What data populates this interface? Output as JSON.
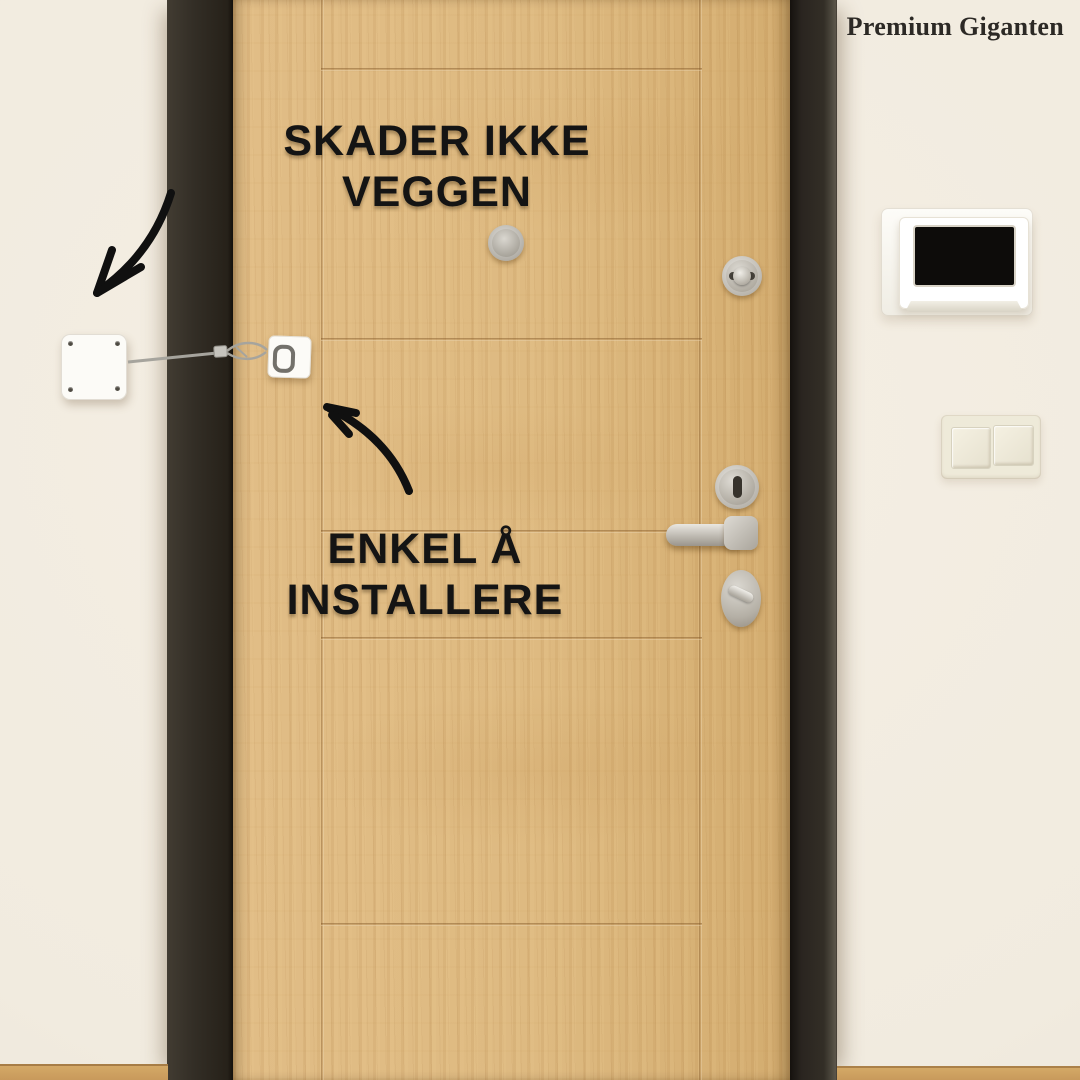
{
  "brand": {
    "label": "Premium Giganten"
  },
  "annotations": {
    "claim_top": {
      "line1": "SKADER IKKE",
      "line2": "VEGGEN"
    },
    "claim_bottom": {
      "line1": "ENKEL Å",
      "line2": "INSTALLERE"
    }
  },
  "icons": {
    "arrow_to_wall_plate": "curved-arrow-down-left",
    "arrow_to_door_unit": "curved-arrow-up-left"
  },
  "colors": {
    "wall": "#f3ede2",
    "door_wood": "#ddb87e",
    "door_frame": "#2e2a23",
    "headline_text": "#141414",
    "brand_text": "#2c2925",
    "device_white": "#fcfbf7",
    "hardware_metal": "#c9c5bd",
    "skirting_wood": "#c99a5c",
    "intercom_screen": "#0d0c0a"
  }
}
